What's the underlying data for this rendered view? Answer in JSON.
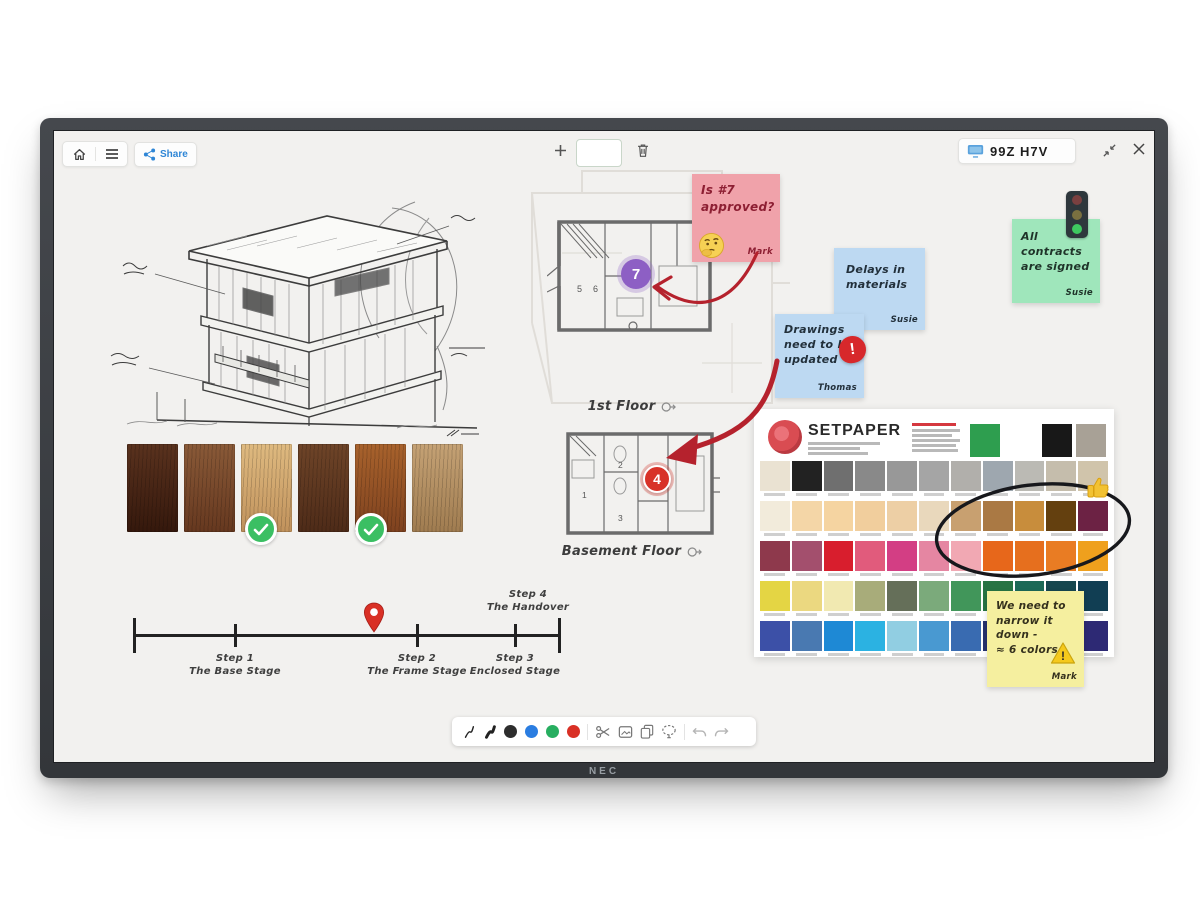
{
  "device": {
    "brand": "NEC",
    "room_code": "99Z H7V"
  },
  "topbar": {
    "share_label": "Share",
    "accent_blue": "#2f86d6"
  },
  "stickies": [
    {
      "id": "pink",
      "color": "#f0a2aa",
      "text_color": "#8d1f33",
      "lines": [
        "Is #7",
        "approved?"
      ],
      "author": "Mark",
      "icon": "thinking-face-emoji"
    },
    {
      "id": "blue-delays",
      "color": "#bdd9f2",
      "text_color": "#22303b",
      "lines": [
        "Delays in",
        "materials"
      ],
      "author": "Susie",
      "icon": null
    },
    {
      "id": "blue-drawings",
      "color": "#bdd9f2",
      "text_color": "#22303b",
      "lines": [
        "Drawings",
        "need to be",
        "updated"
      ],
      "author": "Thomas",
      "icon": "alert-icon"
    },
    {
      "id": "green",
      "color": "#9fe6bb",
      "text_color": "#1f3329",
      "lines": [
        "All",
        "contracts",
        "are signed"
      ],
      "author": "Susie",
      "icon": "traffic-light-icon"
    },
    {
      "id": "yellow",
      "color": "#f5ef9f",
      "text_color": "#35311d",
      "lines": [
        "We need to",
        "narrow it",
        "down -",
        "≈ 6 colors"
      ],
      "author": "Mark",
      "icon": "warning-icon"
    }
  ],
  "glyphs": {
    "alert": "!",
    "warning": "!"
  },
  "floorplans": {
    "first": {
      "label": "1st Floor",
      "marker": "7",
      "rooms": [
        "5",
        "6"
      ]
    },
    "basement": {
      "label": "Basement Floor",
      "marker": "4",
      "rooms": [
        "1",
        "2",
        "3"
      ]
    }
  },
  "timeline": {
    "steps": [
      {
        "label": "Step 1",
        "sub": "The Base Stage"
      },
      {
        "label": "Step 2",
        "sub": "The Frame Stage"
      },
      {
        "label": "Step 3",
        "sub": "Enclosed Stage"
      },
      {
        "label": "Step 4",
        "sub": "The Handover"
      }
    ],
    "pin_color": "#d93025"
  },
  "wood": {
    "samples": [
      {
        "light": "#5a321e",
        "base": "#35180c"
      },
      {
        "light": "#8a5a38",
        "base": "#66381f"
      },
      {
        "light": "#dfba80",
        "base": "#c1925c"
      },
      {
        "light": "#6e4428",
        "base": "#4e2b18"
      },
      {
        "light": "#a8622c",
        "base": "#7f421f"
      },
      {
        "light": "#c5a275",
        "base": "#a07c50"
      }
    ]
  },
  "setpaper": {
    "title": "SETPAPER",
    "logo_color": "#d5383f",
    "header_swatches": [
      "#2e9e4f",
      "#181818",
      "#a8a196"
    ],
    "rows": [
      [
        "#eae2d2",
        "#222222",
        "#6f6f6f",
        "#898989",
        "#989898",
        "#a5a5a5",
        "#b1afab",
        "#9ea7af",
        "#bbbab4",
        "#c5bdac",
        "#d0c4ab"
      ],
      [
        "#f2ebdb",
        "#f4d6a7",
        "#f5d4a1",
        "#f1ce9d",
        "#edcfa5",
        "#e9d8bc",
        "#c8a070",
        "#aa7944",
        "#c88d3c",
        "#64400f",
        "#6c2244"
      ],
      [
        "#8e394c",
        "#a34f6d",
        "#d81e2d",
        "#e15b7c",
        "#d33e84",
        "#e586a2",
        "#f1a8b3",
        "#e7671b",
        "#e66f1e",
        "#e97c23",
        "#efa01d"
      ],
      [
        "#e4d544",
        "#ebd880",
        "#f1e9b1",
        "#a8ac7a",
        "#656f59",
        "#7baa7b",
        "#41965a",
        "#277343",
        "#1c6957",
        "#16464e",
        "#113e53"
      ],
      [
        "#3c50a7",
        "#4979b1",
        "#1e89d5",
        "#2bb2e2",
        "#91cee2",
        "#4999d1",
        "#396bb1",
        "#26326e",
        "#3e2984",
        "#54259a",
        "#2d2974"
      ]
    ]
  },
  "toolbar": {
    "pen_colors": [
      "#2d2d2d",
      "#2a7de1",
      "#27ae60",
      "#d93025"
    ]
  }
}
